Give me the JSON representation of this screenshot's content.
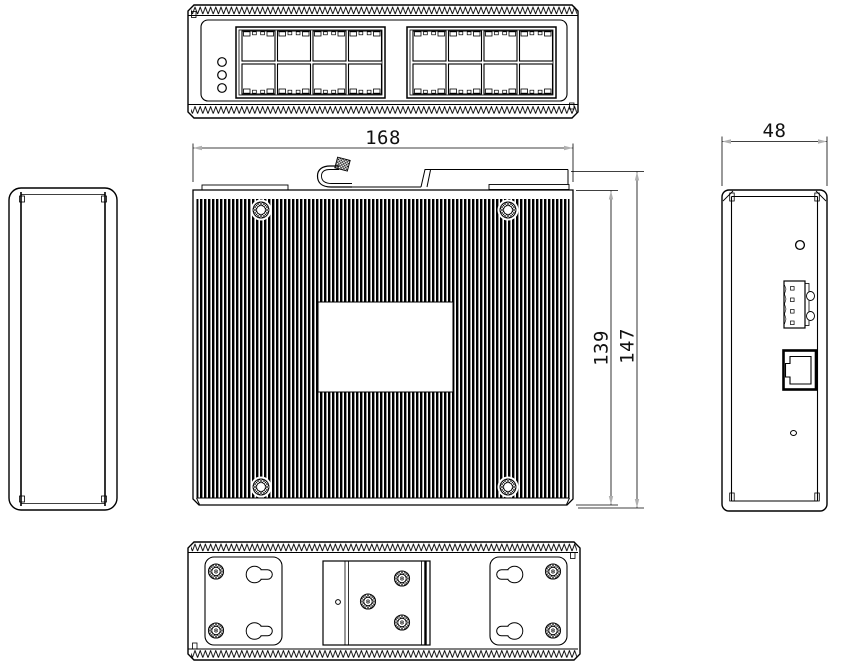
{
  "dimensions": {
    "width": "168",
    "inner_height": "139",
    "overall_height": "147",
    "depth": "48"
  },
  "colors": {
    "line": "#000000",
    "dimension_arrow": "#b0b0b0",
    "background": "#ffffff"
  }
}
